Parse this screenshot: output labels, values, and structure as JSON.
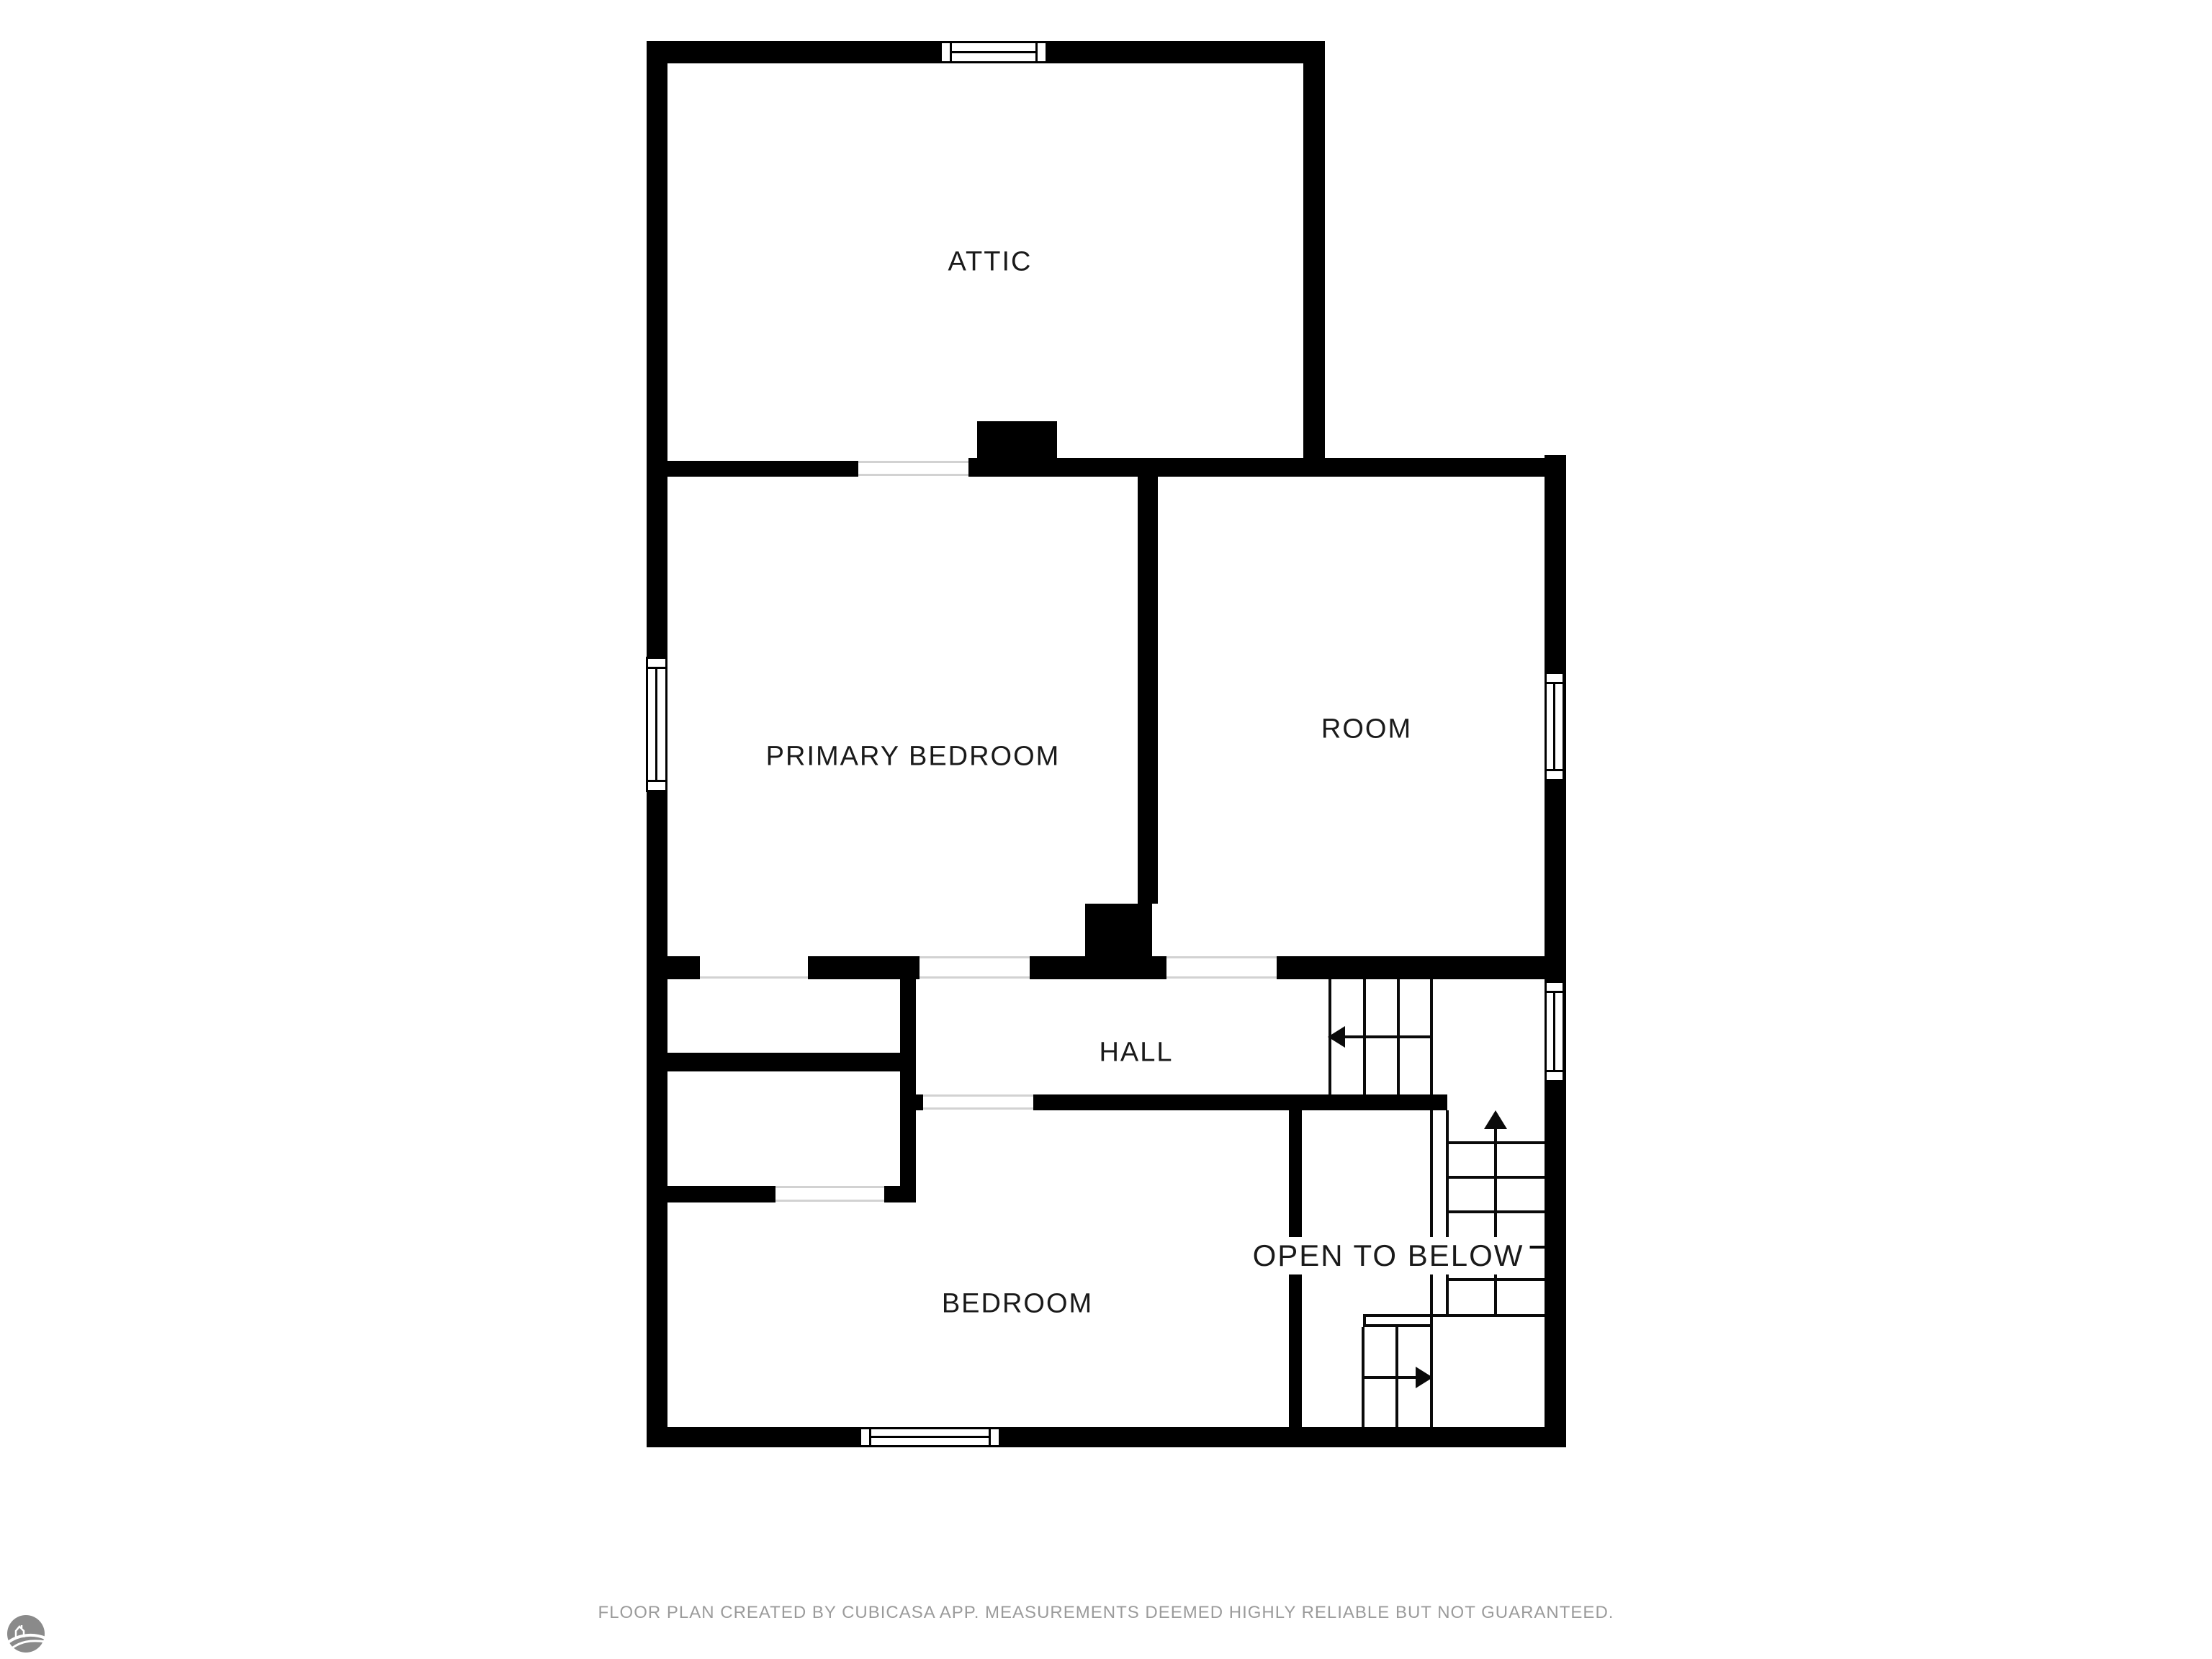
{
  "document": {
    "type": "floor-plan",
    "background": "#ffffff"
  },
  "colors": {
    "wall": "#000000",
    "stair_line": "#0a0a0a",
    "opening_line": "#d2d2d2",
    "label_text": "#1a1a1a",
    "footer_text": "#9b9b9b",
    "logo_gray": "#8a8a8a"
  },
  "rooms": {
    "attic": {
      "label": "ATTIC"
    },
    "primary_bedroom": {
      "label": "PRIMARY BEDROOM"
    },
    "room": {
      "label": "ROOM"
    },
    "hall": {
      "label": "HALL"
    },
    "open_to_below": {
      "label": "OPEN TO BELOW"
    },
    "bedroom": {
      "label": "BEDROOM"
    }
  },
  "stairs": {
    "hall_run_arrow": "left",
    "upper_run_arrow": "up",
    "lower_run_arrow": "right"
  },
  "windows": {
    "count": 5,
    "locations": [
      "attic-top",
      "primary-bedroom-left",
      "room-right",
      "stair-landing-right",
      "bedroom-bottom"
    ]
  },
  "footer": {
    "disclaimer": "FLOOR PLAN CREATED BY CUBICASA APP. MEASUREMENTS DEEMED HIGHLY RELIABLE BUT NOT GUARANTEED."
  },
  "logo": {
    "icon": "cubicasa-logo"
  }
}
